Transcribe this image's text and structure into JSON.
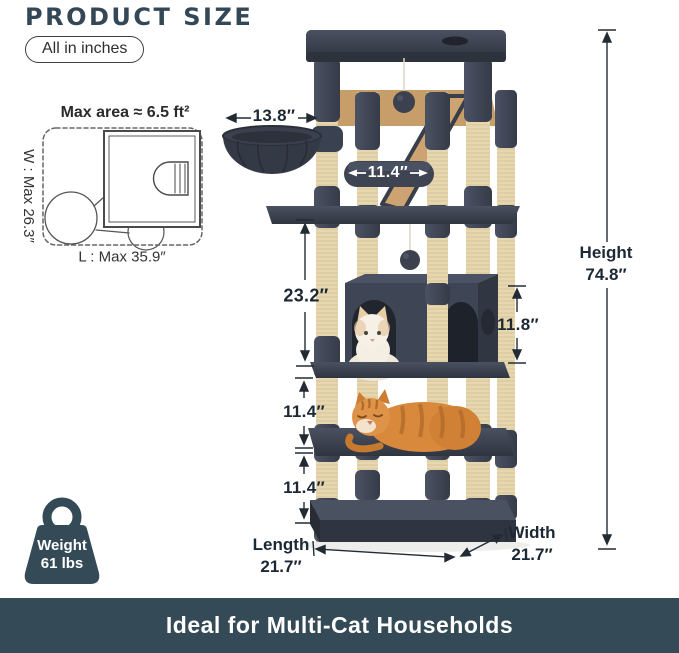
{
  "header": {
    "title": "PRODUCT SIZE",
    "unit_badge": "All in inches"
  },
  "footprint_diagram": {
    "max_area": "Max area ≈ 6.5 ft²",
    "width_label": "W : Max 26.3″",
    "length_label": "L : Max 35.9″"
  },
  "tree_dimensions": {
    "basket_width": "13.8″",
    "top_perch_width": "11.4″",
    "upper_section_height": "23.2″",
    "condo_height": "11.8″",
    "middle_gap_height": "11.4″",
    "bottom_gap_height": "11.4″",
    "height": {
      "label": "Height",
      "value": "74.8″"
    },
    "length": {
      "label": "Length",
      "value": "21.7″"
    },
    "width": {
      "label": "Width",
      "value": "21.7″"
    }
  },
  "weight_badge": {
    "label": "Weight",
    "value": "61 lbs"
  },
  "footer": {
    "caption": "Ideal for Multi-Cat Households"
  },
  "colors": {
    "accent_text": "#334757",
    "dimension_text": "#1c2834",
    "footer_bar": "#344a56",
    "tree_plush": "#3f4553",
    "tree_sisal": "#e8dab6",
    "wood_panel": "#c79e6a",
    "cat_orange": "#d8893c",
    "cat_cream": "#f4eee3"
  }
}
